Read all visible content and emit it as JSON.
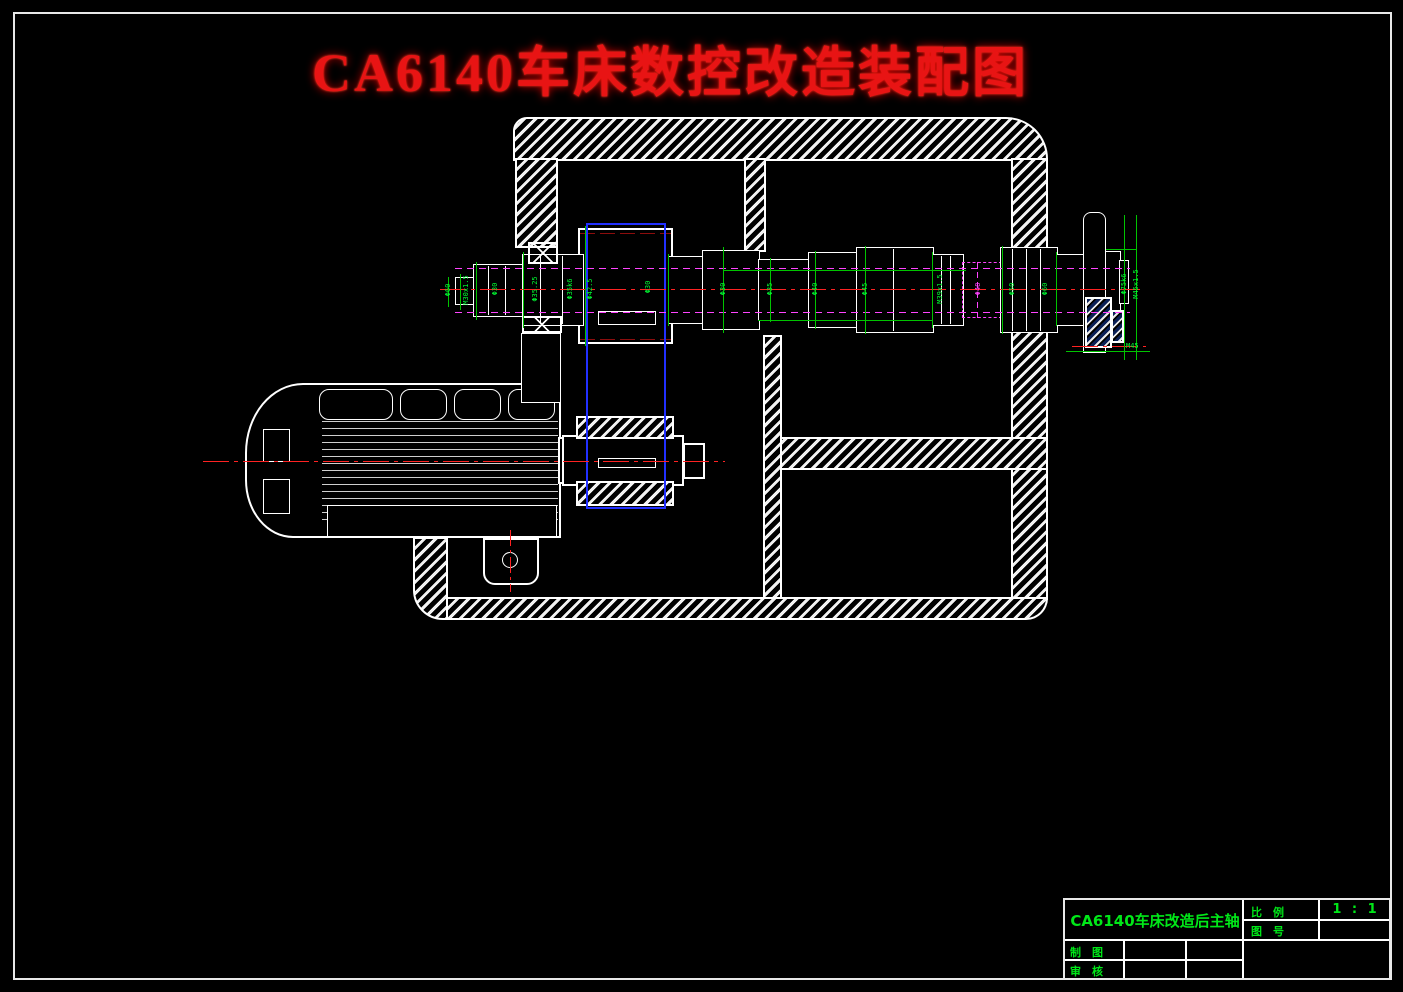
{
  "drawing": {
    "title": "CA6140车床数控改造装配图",
    "title_color": "#e81414"
  },
  "title_block": {
    "part_name": "CA6140车床改造后主轴",
    "scale_label": "比　例",
    "scale_value": "1 : 1",
    "drawing_no_label": "图　号",
    "drawn_label": "制　图",
    "checked_label": "审　核",
    "text_color": "#00e818"
  },
  "colors": {
    "background": "#000000",
    "outline": "#ffffff",
    "dimension_green": "#00ff33",
    "hidden_magenta": "#ff44ff",
    "centerline_red": "#ff2222",
    "pitchline_dark_red": "#8c0d0d",
    "gear_box_blue": "#2230ff"
  },
  "dims": {
    "d0": "Φ60",
    "d1": "M30x1.5",
    "d2": "Φ30",
    "d3": "Φ35.25",
    "d4": "Φ35k6",
    "d5": "Φ42.5",
    "d6": "Φ30",
    "d7": "Φ30",
    "d8": "Φ35",
    "d9": "Φ40",
    "d10": "Φ45",
    "d11": "M39x1.5",
    "d12": "Φ48",
    "d13": "Φ50",
    "d14": "Φ60",
    "d15": "Φ75k6",
    "d16": "M45x1.5",
    "d17": "M45"
  }
}
